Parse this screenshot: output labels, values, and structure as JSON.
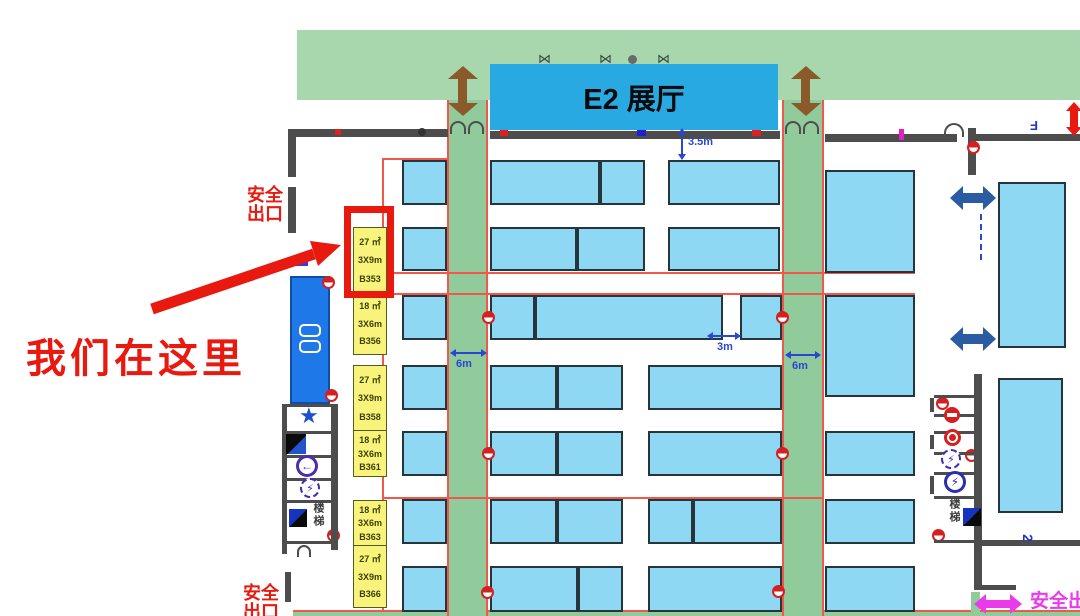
{
  "hall_banner": {
    "label": "E2 展厅"
  },
  "callout": {
    "text": "我们在这里"
  },
  "exits": {
    "top_left": {
      "l1": "安全",
      "l2": "出口"
    },
    "bottom_left": {
      "l1": "安全",
      "l2": "出口"
    },
    "bottom_right": {
      "text": "安全出口"
    }
  },
  "booth_labels": [
    {
      "area": "27 ㎡",
      "size": "3X9m",
      "code": "B353",
      "highlighted": true
    },
    {
      "area": "18 ㎡",
      "size": "3X6m",
      "code": "B356",
      "highlighted": false
    },
    {
      "area": "27 ㎡",
      "size": "3X9m",
      "code": "B358",
      "highlighted": false
    },
    {
      "area": "18 ㎡",
      "size": "3X6m",
      "code": "B361",
      "highlighted": false
    },
    {
      "area": "18 ㎡",
      "size": "3X6m",
      "code": "B363",
      "highlighted": false
    },
    {
      "area": "27 ㎡",
      "size": "3X9m",
      "code": "B366",
      "highlighted": false
    }
  ],
  "dimensions": {
    "top_clearance": "3.5m",
    "left_aisle": "6m",
    "right_aisle": "6m",
    "cross_gap": "3m"
  },
  "stairs": {
    "left": "楼梯",
    "right": "楼梯"
  },
  "marks": {
    "floor": "2",
    "wall_letter": "F"
  },
  "icons": {
    "star": "★",
    "lightning": "⚡",
    "arrow_left": "←",
    "door_glyph": "⋈"
  },
  "colors": {
    "accent_red": "#e8190f",
    "booth_blue": "#8fd8f4",
    "aisle_green": "#92cb9b",
    "banner_green": "#a8d6ad",
    "banner_blue": "#29a9e1",
    "label_yellow": "#f7f37b",
    "magenta": "#ea3bea",
    "dim_blue": "#2947d0",
    "navy": "#2b5ba3",
    "wall_gray": "#4d4d4d"
  }
}
